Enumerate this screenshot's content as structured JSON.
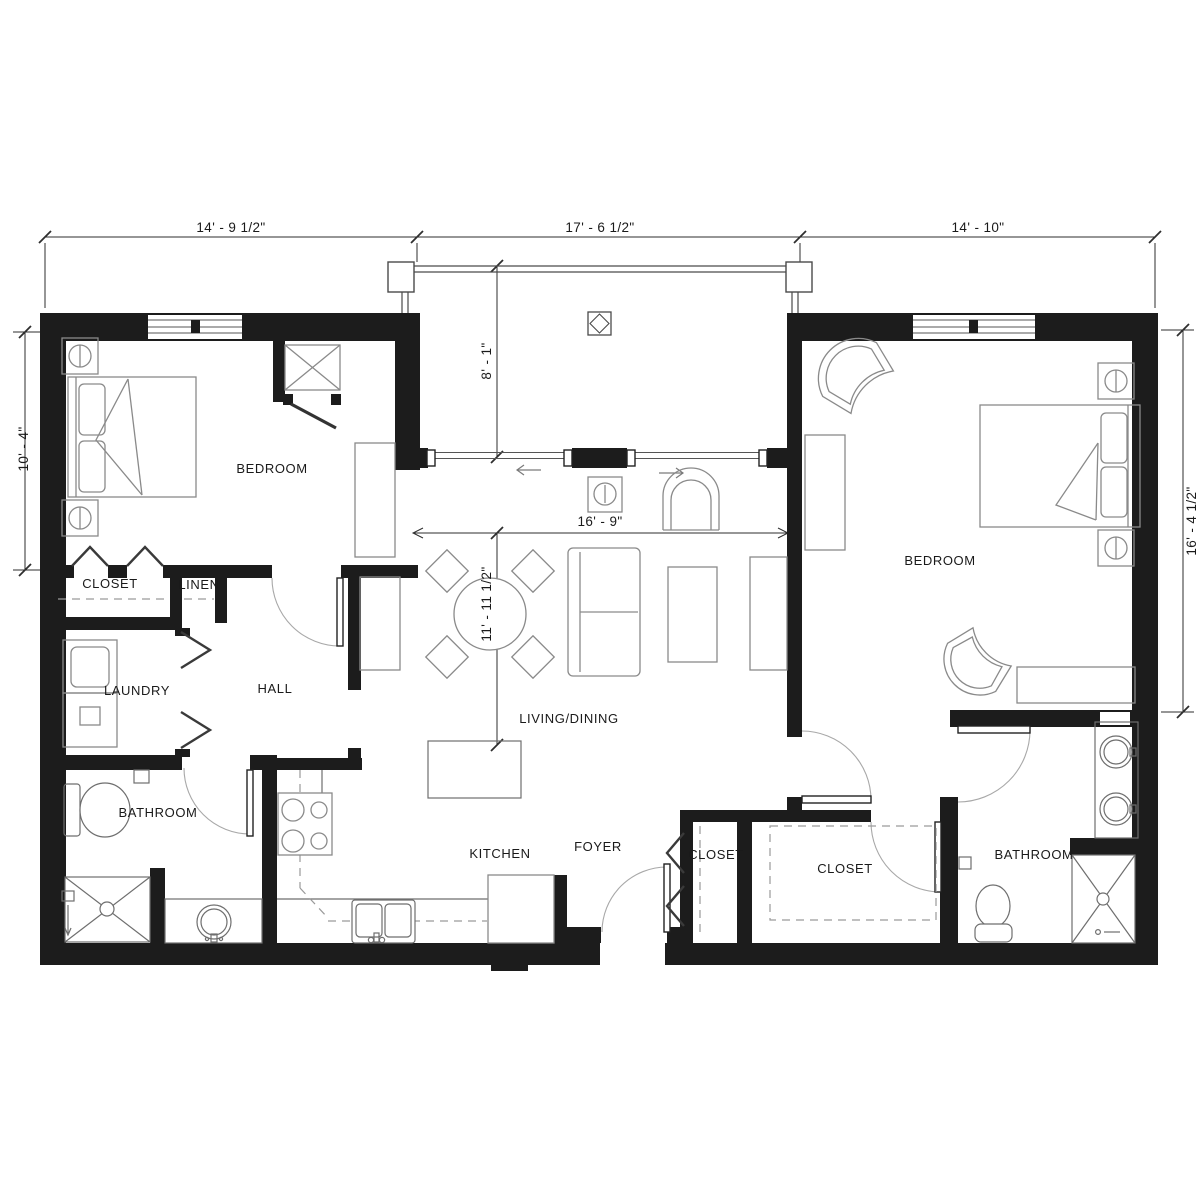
{
  "colors": {
    "wall": "#1c1c1c",
    "line": "#8a8a8a",
    "dimension": "#2e2e2e",
    "background": "#ffffff"
  },
  "dimensions": {
    "top_left_wing": "14' - 9 1/2\"",
    "top_center": "17' - 6 1/2\"",
    "top_right_wing": "14' - 10\"",
    "left_side": "10' - 4\"",
    "right_side": "16' - 4 1/2\"",
    "balcony_depth": "8' - 1\"",
    "living_width": "16' - 9\"",
    "living_depth": "11' - 11 1/2\""
  },
  "rooms": {
    "bedroom_left": "BEDROOM",
    "closet_bedroom_left": "CLOSET",
    "linen": "LINEN",
    "laundry": "LAUNDRY",
    "hall": "HALL",
    "bathroom_left": "BATHROOM",
    "kitchen": "KITCHEN",
    "foyer": "FOYER",
    "living_dining": "LIVING/DINING",
    "closet_foyer": "CLOSET",
    "closet_walkin": "CLOSET",
    "bedroom_right": "BEDROOM",
    "bathroom_right": "BATHROOM"
  }
}
